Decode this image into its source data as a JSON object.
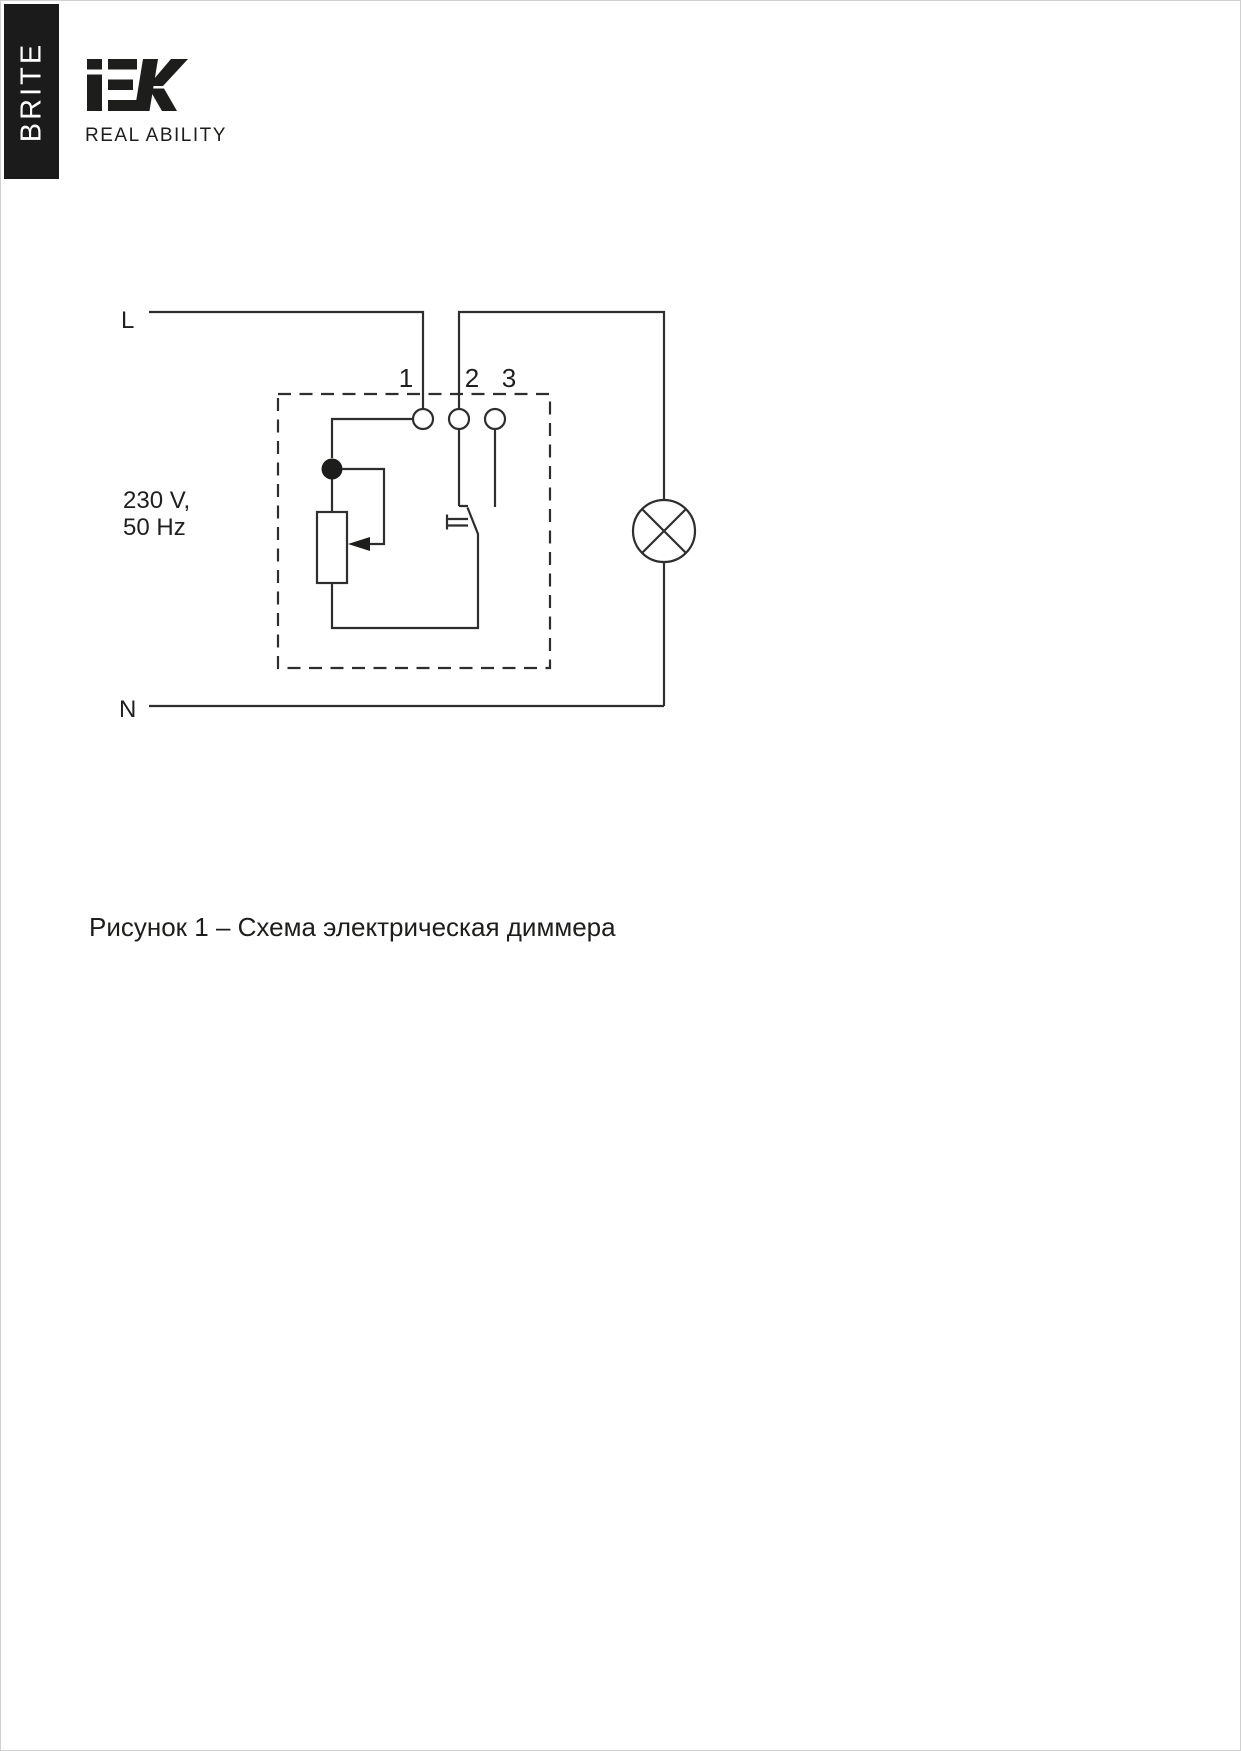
{
  "page": {
    "background": "#ffffff",
    "border_color": "#cfcfcf"
  },
  "header": {
    "series_badge": "BRITE",
    "brand": "IEK",
    "tagline": "REAL ABILITY"
  },
  "diagram": {
    "labels": {
      "line": "L",
      "neutral": "N",
      "voltage": "230 V,",
      "frequency": "50 Hz",
      "terminal_1": "1",
      "terminal_2": "2",
      "terminal_3": "3"
    },
    "colors": {
      "stroke": "#2e2e2e",
      "banner_bg": "#1b1b1b",
      "logo": "#1d1d1b"
    }
  },
  "caption": {
    "text": "Рисунок 1 – Схема электрическая диммера"
  }
}
